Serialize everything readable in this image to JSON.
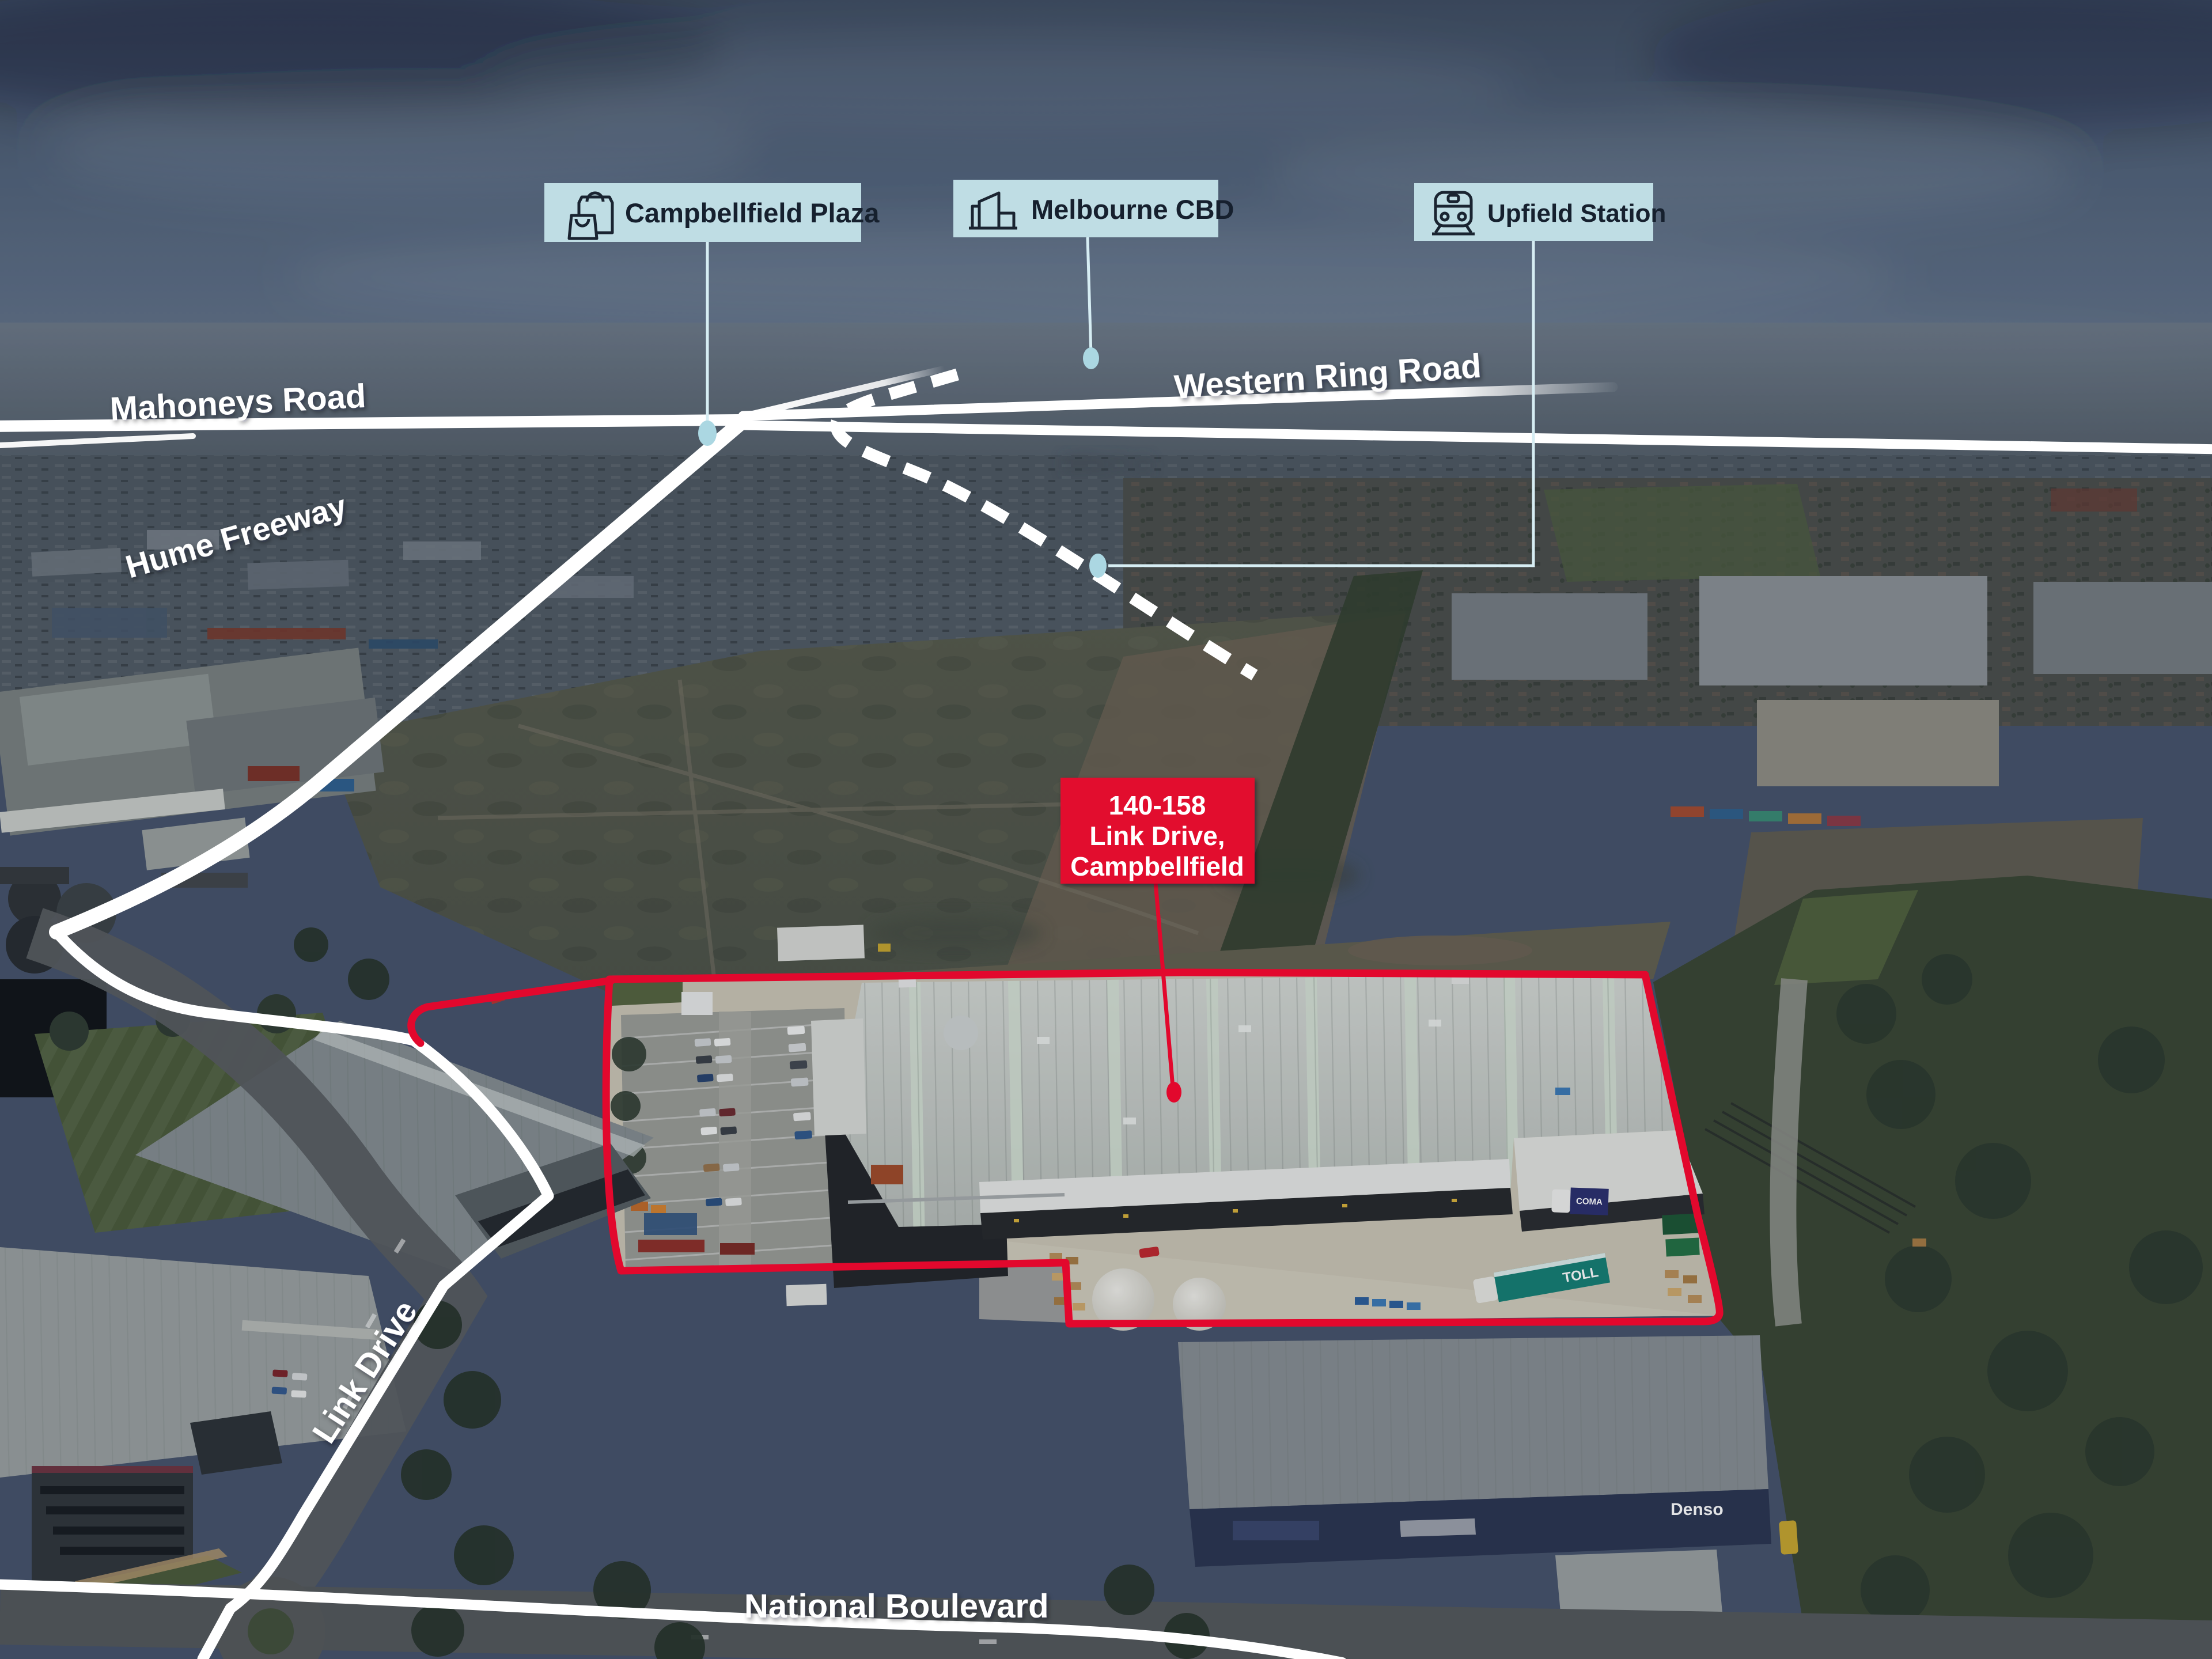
{
  "callouts": [
    {
      "id": "campbellfield-plaza",
      "label": "Campbellfield Plaza",
      "icon": "shopping-bag"
    },
    {
      "id": "melbourne-cbd",
      "label": "Melbourne CBD",
      "icon": "city-buildings"
    },
    {
      "id": "upfield-station",
      "label": "Upfield Station",
      "icon": "train"
    }
  ],
  "road_labels": {
    "mahoneys": "Mahoneys Road",
    "western_ring": "Western Ring Road",
    "hume": "Hume Freeway",
    "link": "Link Drive",
    "national": "National Boulevard"
  },
  "property": {
    "line1": "140-158",
    "line2": "Link Drive,",
    "line3": "Campbellfield"
  },
  "vehicles": {
    "toll": "TOLL",
    "coma": "COMA"
  },
  "signs": {
    "denso": "Denso"
  },
  "colors": {
    "accent_red": "#e2082d",
    "callout_bg": "#bfdde4",
    "callout_text": "#16202e",
    "connector": "#d6edf3",
    "connector_dot": "#abd7e2",
    "road_white": "#ffffff"
  }
}
